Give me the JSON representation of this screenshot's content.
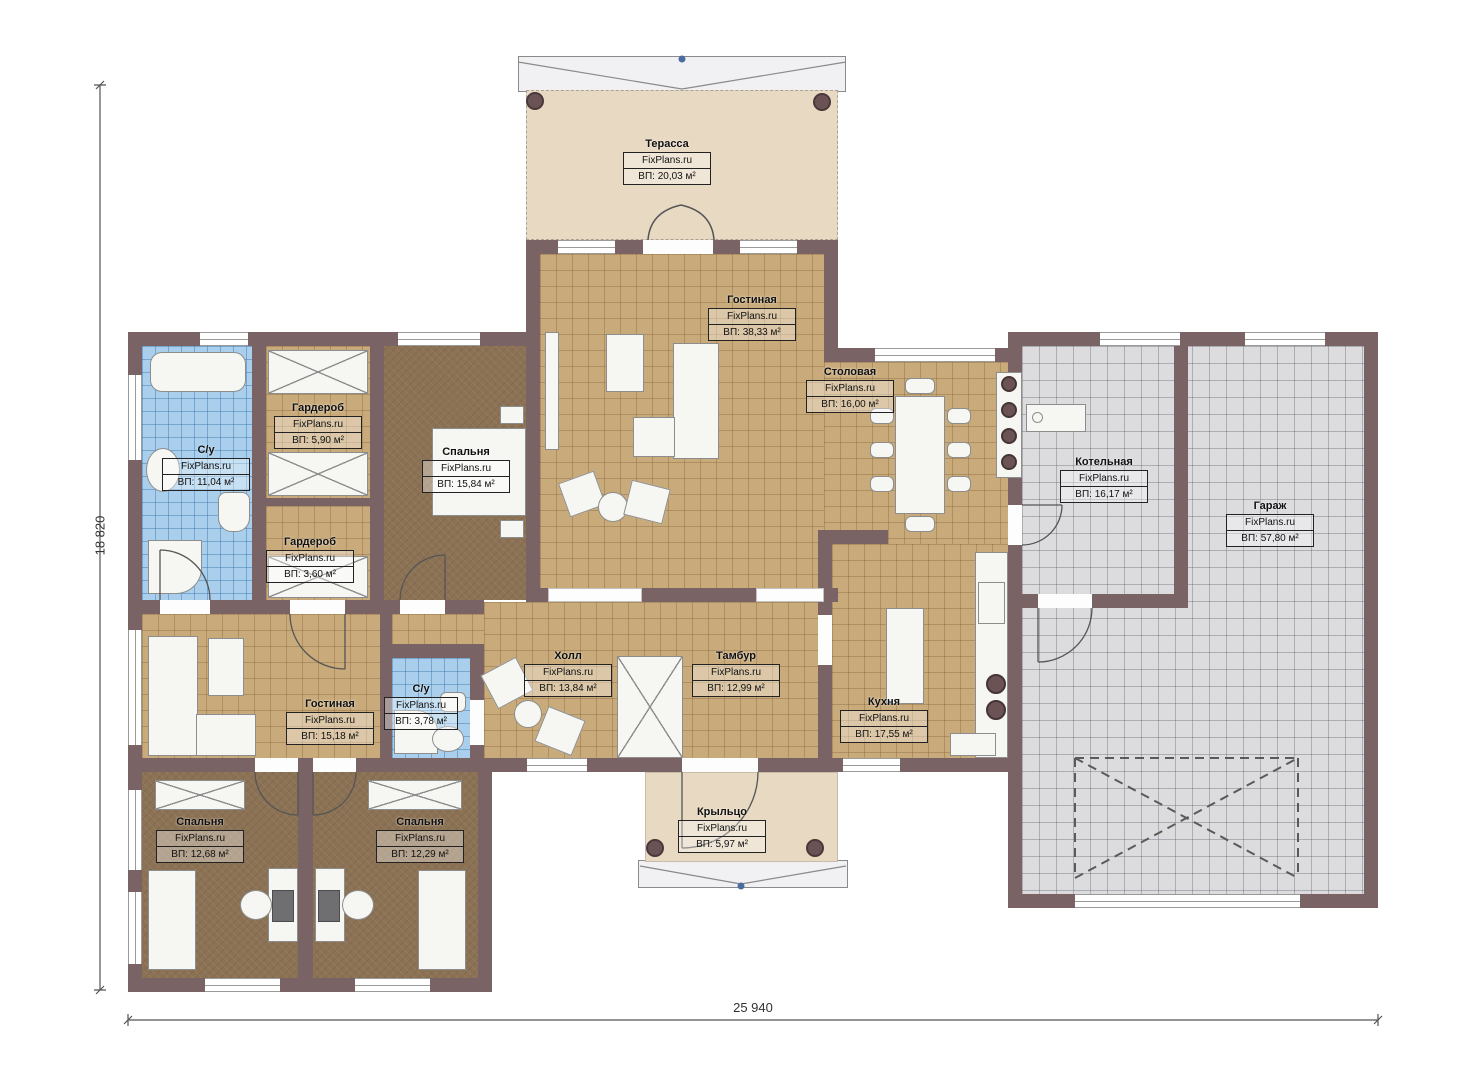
{
  "plan": {
    "brand": "FixPlans.ru",
    "dimensions": {
      "height_label": "18 820",
      "width_label": "25 940"
    },
    "rooms": [
      {
        "name": "Терасса",
        "area": "ВП: 20,03 м²"
      },
      {
        "name": "Гостиная",
        "area": "ВП: 38,33 м²"
      },
      {
        "name": "Столовая",
        "area": "ВП: 16,00 м²"
      },
      {
        "name": "Гардероб",
        "area": "ВП: 5,90 м²"
      },
      {
        "name": "С/у",
        "area": "ВП: 11,04 м²"
      },
      {
        "name": "Спальня",
        "area": "ВП: 15,84 м²"
      },
      {
        "name": "Гардероб",
        "area": "ВП: 3,60 м²"
      },
      {
        "name": "Котельная",
        "area": "ВП: 16,17 м²"
      },
      {
        "name": "Гараж",
        "area": "ВП: 57,80 м²"
      },
      {
        "name": "Гостиная",
        "area": "ВП: 15,18 м²"
      },
      {
        "name": "С/у",
        "area": "ВП: 3,78 м²"
      },
      {
        "name": "Холл",
        "area": "ВП: 13,84 м²"
      },
      {
        "name": "Тамбур",
        "area": "ВП: 12,99 м²"
      },
      {
        "name": "Кухня",
        "area": "ВП: 17,55 м²"
      },
      {
        "name": "Крыльцо",
        "area": "ВП: 5,97 м²"
      },
      {
        "name": "Спальня",
        "area": "ВП: 12,68 м²"
      },
      {
        "name": "Спальня",
        "area": "ВП: 12,29 м²"
      }
    ],
    "colors": {
      "wall": "#7a6364",
      "floor_tile_tan": "#c9ab7b",
      "floor_wood_brown": "#8c7254",
      "bath_tile_blue": "#a9cfec",
      "garage_tile_gray": "#dcdcdf",
      "terrace_beige": "#e7d9c2"
    }
  }
}
